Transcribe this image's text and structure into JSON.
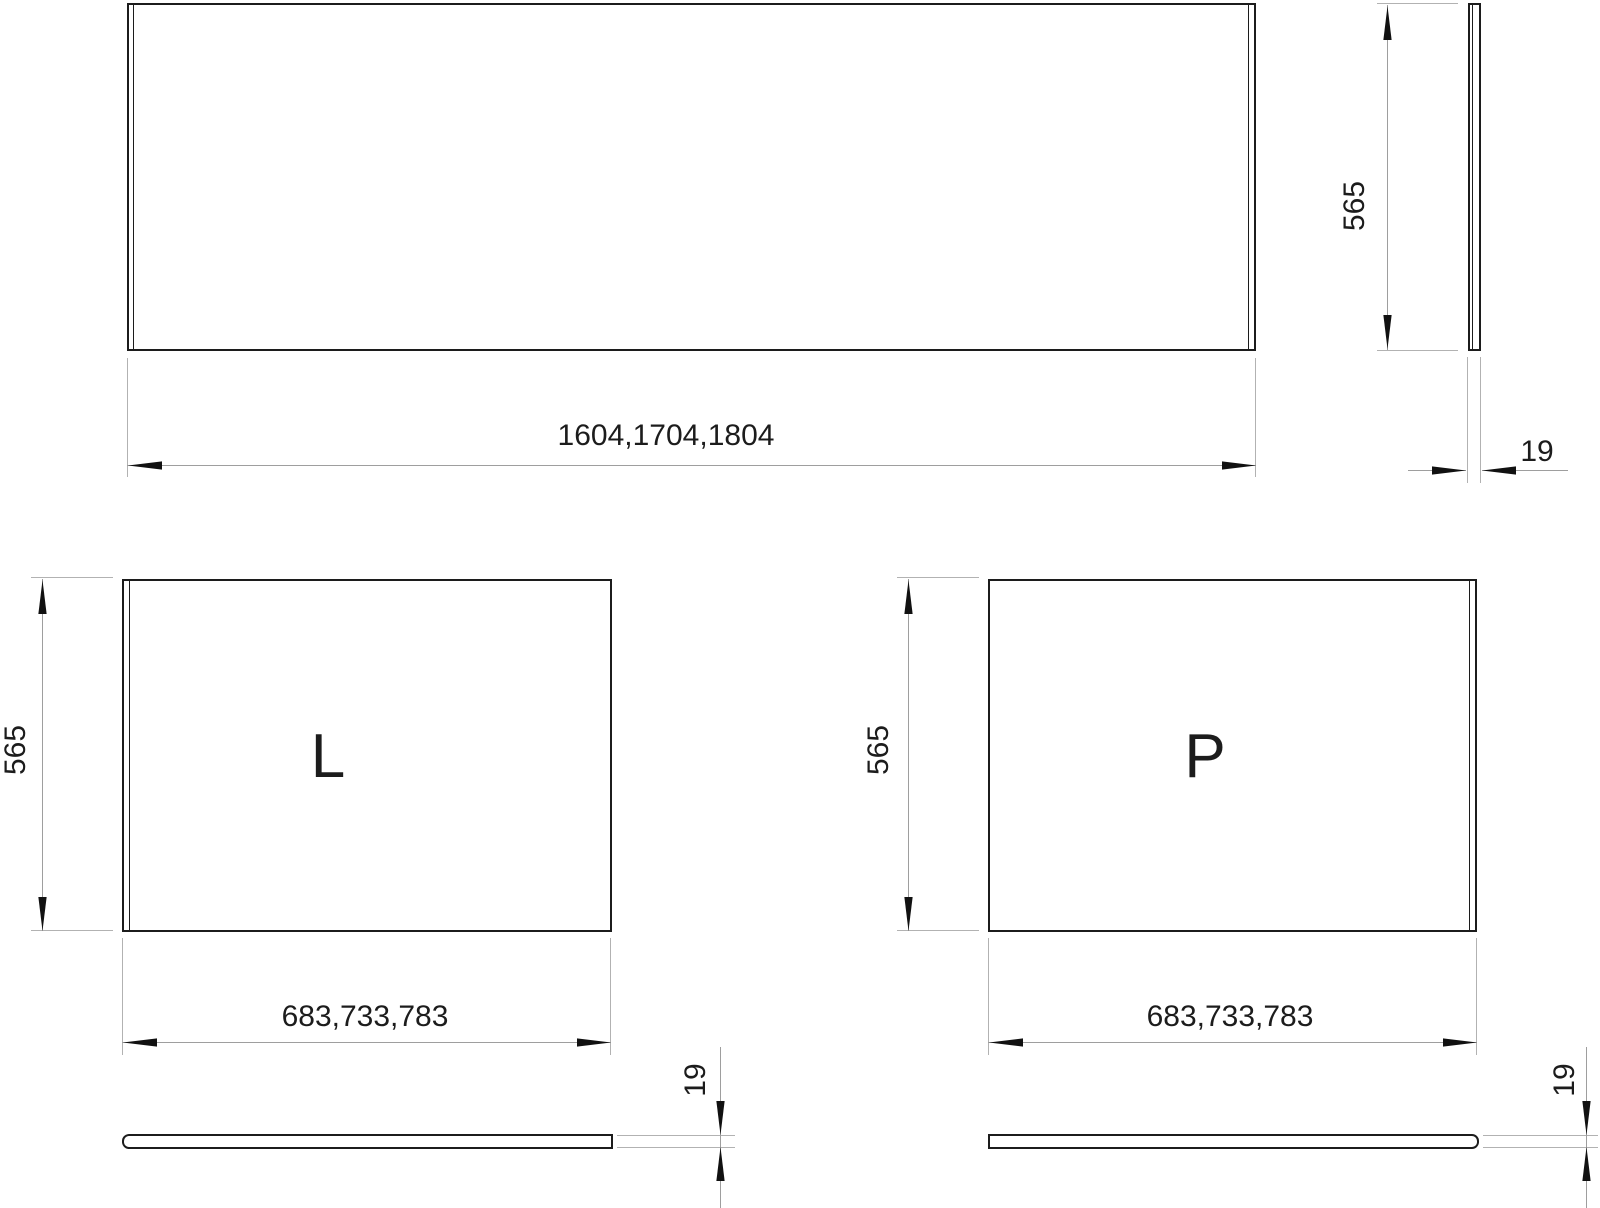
{
  "colors": {
    "object_line": "#1c1c1c",
    "dimension_line": "#9e9e9e",
    "arrow": "#111111",
    "text": "#1c1c1c",
    "background": "#ffffff"
  },
  "views": {
    "front_panel": {
      "width_label": "1604,1704,1804",
      "height_label": "565",
      "thickness_label": "19"
    },
    "panel_l": {
      "label": "L",
      "height_label": "565",
      "width_label": "683,733,783",
      "thickness_label": "19"
    },
    "panel_p": {
      "label": "P",
      "height_label": "565",
      "width_label": "683,733,783",
      "thickness_label": "19"
    }
  }
}
